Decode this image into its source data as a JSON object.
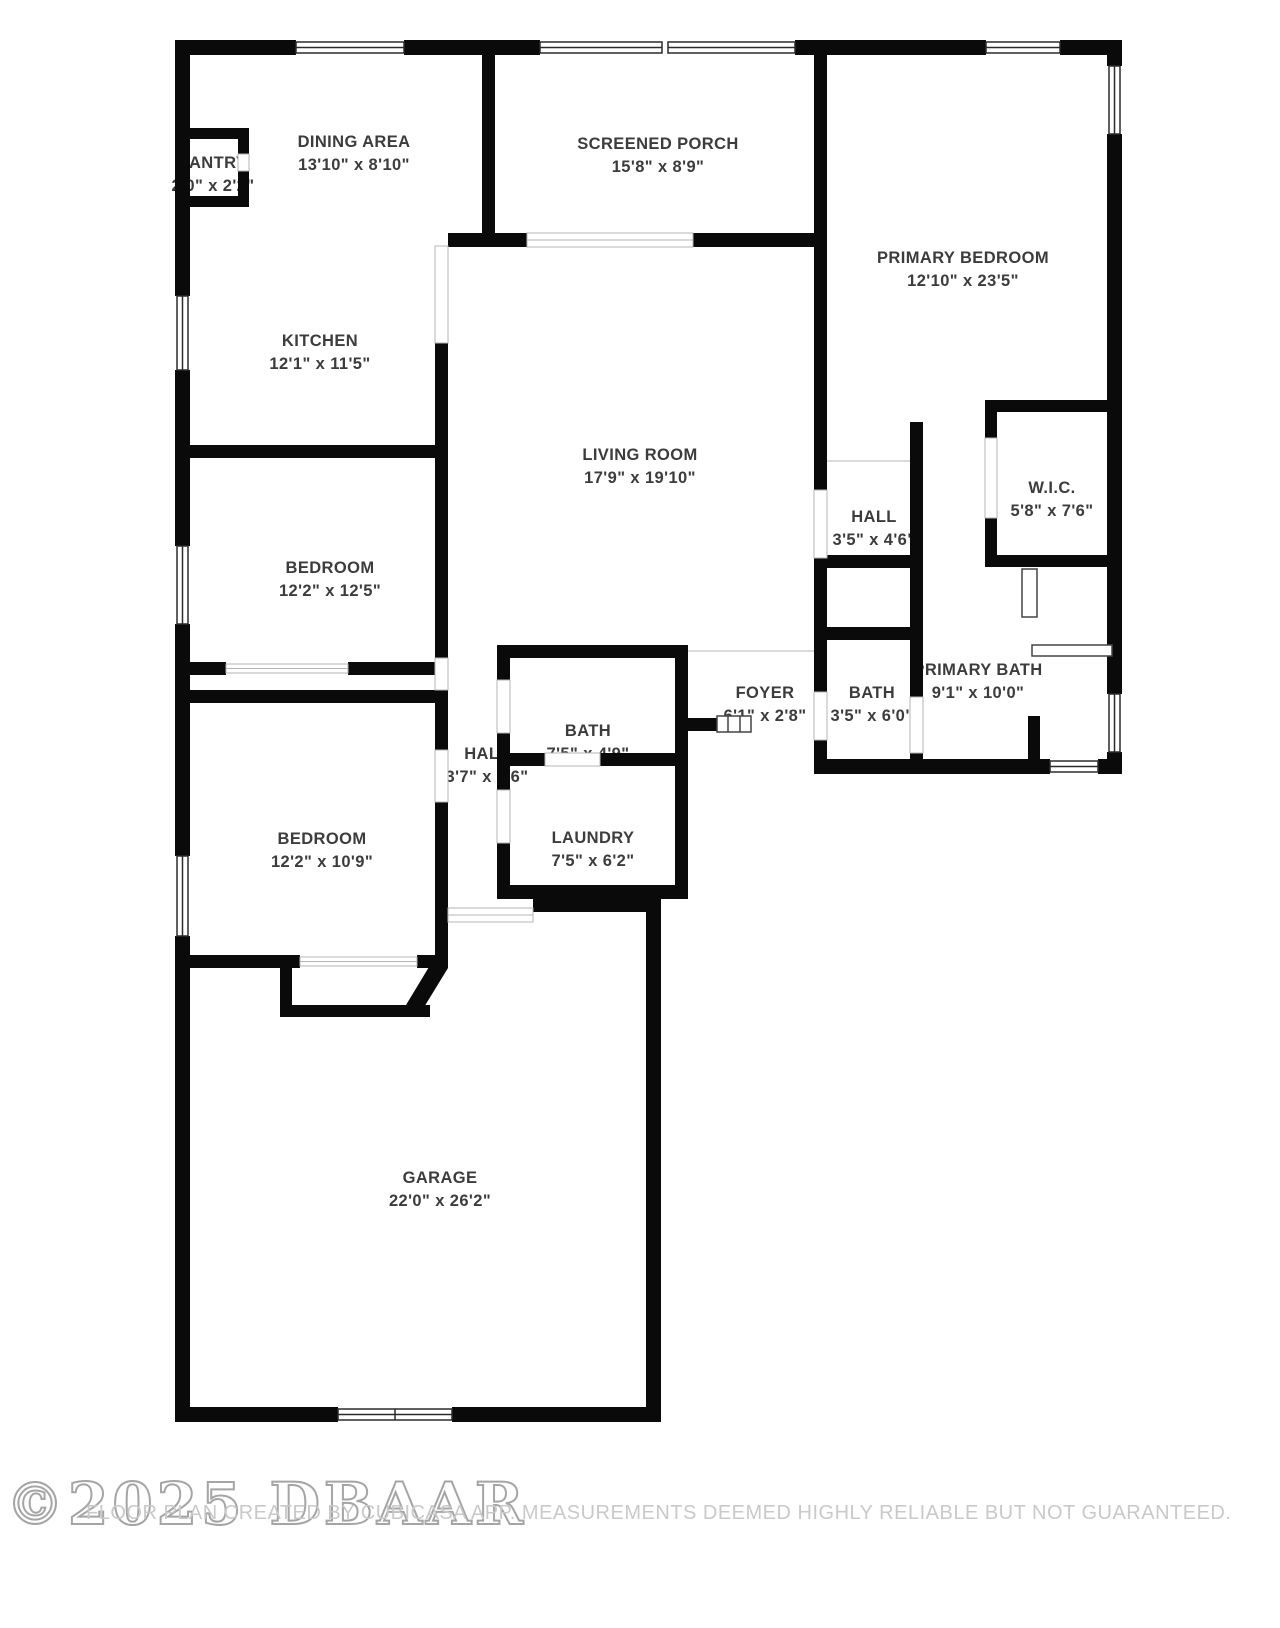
{
  "plan": {
    "rooms": [
      {
        "id": "dining-area",
        "name": "DINING AREA",
        "dims": "13'10\" x 8'10\""
      },
      {
        "id": "pantry",
        "name": "PANTRY",
        "dims": "2'0\" x 2'2\""
      },
      {
        "id": "screened-porch",
        "name": "SCREENED PORCH",
        "dims": "15'8\" x 8'9\""
      },
      {
        "id": "primary-bedroom",
        "name": "PRIMARY BEDROOM",
        "dims": "12'10\" x 23'5\""
      },
      {
        "id": "kitchen",
        "name": "KITCHEN",
        "dims": "12'1\" x 11'5\""
      },
      {
        "id": "living-room",
        "name": "LIVING ROOM",
        "dims": "17'9\" x 19'10\""
      },
      {
        "id": "hall-primary",
        "name": "HALL",
        "dims": "3'5\" x 4'6\""
      },
      {
        "id": "walk-in-closet",
        "name": "W.I.C.",
        "dims": "5'8\" x 7'6\""
      },
      {
        "id": "bedroom-1",
        "name": "BEDROOM",
        "dims": "12'2\" x 12'5\""
      },
      {
        "id": "primary-bath",
        "name": "PRIMARY BATH",
        "dims": "9'1\" x 10'0\""
      },
      {
        "id": "bath-guest",
        "name": "BATH",
        "dims": "3'5\" x 6'0\""
      },
      {
        "id": "foyer",
        "name": "FOYER",
        "dims": "6'1\" x 2'8\""
      },
      {
        "id": "bath-hall",
        "name": "BATH",
        "dims": "7'5\" x 4'9\""
      },
      {
        "id": "hall-bedrooms",
        "name": "HALL",
        "dims": "3'7\" x 8'6\""
      },
      {
        "id": "laundry",
        "name": "LAUNDRY",
        "dims": "7'5\" x 6'2\""
      },
      {
        "id": "bedroom-2",
        "name": "BEDROOM",
        "dims": "12'2\" x 10'9\""
      },
      {
        "id": "garage",
        "name": "GARAGE",
        "dims": "22'0\" x 26'2\""
      }
    ]
  },
  "footer": {
    "watermark": "©2025 DBAAR",
    "disclaimer": "FLOOR PLAN CREATED BY CUBICASA APP. MEASUREMENTS DEEMED HIGHLY RELIABLE BUT NOT GUARANTEED."
  },
  "colors": {
    "wall": "#0a0a0a",
    "label": "#3c3c3c",
    "footer_text": "#c9c9c9",
    "watermark": "#8f8f8f",
    "background": "#ffffff"
  }
}
